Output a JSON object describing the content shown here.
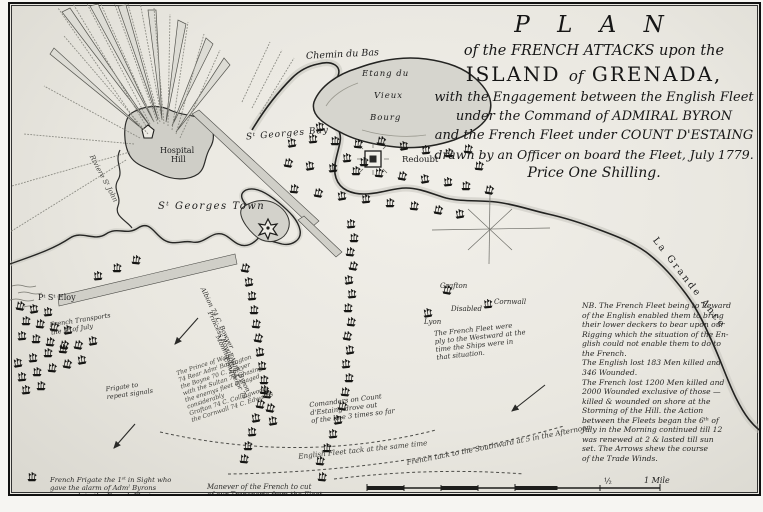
{
  "title": {
    "t1": "P L A N",
    "t2": "of the FRENCH ATTACKS upon the",
    "t3_a": "ISLAND",
    "t3_b": "of",
    "t3_c": "GRENADA,",
    "t4": "with the Engagement between the English Fleet",
    "t5": "under the Command of ADMIRAL BYRON",
    "t6": "and the French Fleet under COUNT D'ESTAING",
    "t7": "drawn by an Officer on board the Fleet, July 1779.",
    "t8": "Price One Shilling."
  },
  "labels": {
    "chemin": "Chemin du Bas",
    "etang1": "Etang du",
    "etang2": "Vieux",
    "etang3": "Bourg",
    "bay": "Sᵗ Georges Bay",
    "hospital1": "Hospital",
    "hospital2": "Hill",
    "town": "Sᵗ Georges Town",
    "redoubt": "Redoubt",
    "grande_ance": "La  Grande  Ance",
    "pt_st_eloy": "Pᵗ Sᵗ Eloy",
    "riviere": "Riviere Sᵗ John",
    "grafton": "Grafton",
    "disabled": "Disabled",
    "cornwall": "Cornwall",
    "lyon": "Lyon",
    "transports1": "French Transports",
    "transports2": "the 3ᵈ of July",
    "frigate_rep1": "Frigate to",
    "frigate_rep2": "repeat signals",
    "eng_tack": "English Fleet tack at the same time",
    "fr_tack": "French tack to the Southward at 5 in the Afternoon",
    "half": "½",
    "mile": "1 Mile"
  },
  "french_fleet_note": {
    "l1": "The French Fleet were",
    "l2": "ply to the Westward at the",
    "l3": "time the Ships were in",
    "l4": "that situation."
  },
  "commanders_note": {
    "l1": "Comanders on Count",
    "l2": "d'Estaing drove out",
    "l3": "of the line 3 times so far"
  },
  "manoeuvre_note": {
    "l1": "Manever of the French to cut",
    "l2": "of our Transports from the Fleet."
  },
  "frigate_note": {
    "l1": "French Frigate the 1ˢᵗ in Sight who",
    "l2": "gave the alarm of Admˡ Byrons",
    "l3": "approach to the French Fleet."
  },
  "ship_names": {
    "l1": "Albion 74 C. Bowyer",
    "l2": "Princess Royal Admˡ Byron",
    "l3": "Monmouth 64",
    "l4": "Conqueror 74",
    "l5": "The Prince of Wales",
    "l6": "74 Rear Admˡ Barrington",
    "l7": "the Boyne 70 C. Sawyer",
    "l8": "with the Sultan 74 Chasing",
    "l9": "the enemys fleet engaged",
    "l10": "considerably",
    "l11": "Grafton 74 C. Collingwood",
    "l12": "the Cornwall 74 C. Edwards"
  },
  "note": {
    "lines": [
      "NB. The French Fleet being to Leward",
      "of the English enabled them to bring",
      "their lower deckers to bear upon our",
      "Rigging which the situation of the En-",
      "glish could not enable them to do to",
      "the French.",
      "The English lost 183 Men killed and",
      "346 Wounded.",
      "The French lost 1200 Men killed and",
      "2000 Wounded exclusive of those —",
      "killed & wounded on shore at the",
      "Storming of the Hill.    the Action",
      "between the Fleets began the 6ᵗʰ of",
      "July in the Morning continued till 12",
      "was renewed at 2 & lasted till sun",
      "set.  The Arrows shew the course",
      "of the Trade Winds."
    ]
  },
  "colors": {
    "ink": "#1b1b1b",
    "paper": "#ece9e2",
    "land": "#d7d6cf",
    "shade": "#c2c1ba"
  },
  "ships": [
    [
      290,
      143
    ],
    [
      311,
      139
    ],
    [
      333,
      141
    ],
    [
      356,
      144
    ],
    [
      379,
      141
    ],
    [
      402,
      146
    ],
    [
      424,
      150
    ],
    [
      447,
      153
    ],
    [
      466,
      149
    ],
    [
      286,
      163
    ],
    [
      308,
      166
    ],
    [
      331,
      168
    ],
    [
      354,
      171
    ],
    [
      377,
      173
    ],
    [
      400,
      176
    ],
    [
      423,
      179
    ],
    [
      446,
      182
    ],
    [
      464,
      186
    ],
    [
      292,
      189
    ],
    [
      316,
      193
    ],
    [
      340,
      196
    ],
    [
      364,
      199
    ],
    [
      388,
      203
    ],
    [
      412,
      206
    ],
    [
      436,
      210
    ],
    [
      458,
      214
    ],
    [
      345,
      158
    ],
    [
      362,
      162
    ],
    [
      477,
      166
    ],
    [
      487,
      190
    ],
    [
      318,
      127
    ],
    [
      349,
      224
    ],
    [
      352,
      238
    ],
    [
      348,
      252
    ],
    [
      351,
      266
    ],
    [
      347,
      280
    ],
    [
      350,
      294
    ],
    [
      346,
      308
    ],
    [
      349,
      322
    ],
    [
      345,
      336
    ],
    [
      348,
      350
    ],
    [
      344,
      364
    ],
    [
      347,
      378
    ],
    [
      343,
      392
    ],
    [
      340,
      406
    ],
    [
      336,
      420
    ],
    [
      331,
      434
    ],
    [
      325,
      448
    ],
    [
      318,
      461
    ],
    [
      243,
      268
    ],
    [
      247,
      282
    ],
    [
      250,
      296
    ],
    [
      252,
      310
    ],
    [
      254,
      324
    ],
    [
      256,
      338
    ],
    [
      258,
      352
    ],
    [
      260,
      366
    ],
    [
      262,
      380
    ],
    [
      265,
      394
    ],
    [
      268,
      408
    ],
    [
      271,
      421
    ],
    [
      96,
      276
    ],
    [
      115,
      268
    ],
    [
      134,
      260
    ],
    [
      18,
      306
    ],
    [
      32,
      309
    ],
    [
      46,
      312
    ],
    [
      24,
      321
    ],
    [
      38,
      324
    ],
    [
      52,
      327
    ],
    [
      66,
      330
    ],
    [
      20,
      336
    ],
    [
      34,
      339
    ],
    [
      48,
      342
    ],
    [
      62,
      345
    ],
    [
      16,
      363
    ],
    [
      31,
      358
    ],
    [
      46,
      353
    ],
    [
      61,
      349
    ],
    [
      76,
      345
    ],
    [
      91,
      341
    ],
    [
      20,
      377
    ],
    [
      35,
      372
    ],
    [
      50,
      368
    ],
    [
      65,
      364
    ],
    [
      80,
      360
    ],
    [
      24,
      390
    ],
    [
      39,
      386
    ],
    [
      262,
      390
    ],
    [
      258,
      404
    ],
    [
      254,
      418
    ],
    [
      250,
      432
    ],
    [
      246,
      446
    ],
    [
      242,
      459
    ],
    [
      445,
      290
    ],
    [
      426,
      313
    ],
    [
      486,
      304
    ],
    [
      30,
      477
    ],
    [
      320,
      477
    ]
  ]
}
